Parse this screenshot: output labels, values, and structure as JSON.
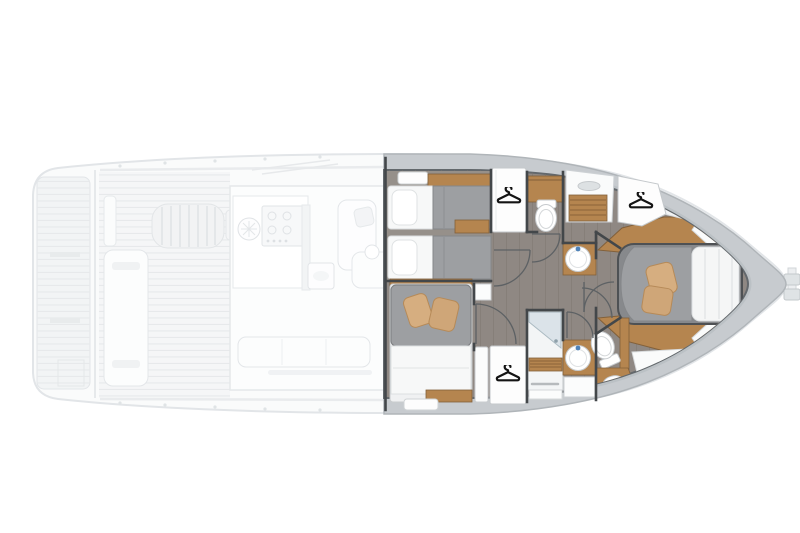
{
  "meta": {
    "alt": "Motor yacht deck plan: ghosted main deck aft (swim platform, cockpit, galley and salon) and a rendered lower deck forward with guest cabins, heads and owner cabin in the bow"
  },
  "palette": {
    "background": "#ffffff",
    "ghost_fill": "#f4f5f6",
    "ghost_line": "#e2e5e8",
    "hull_band": "#c7cbcf",
    "hull_band_edge": "#b0b5b9",
    "floor_wood": "#8f8883",
    "floor_plank_line": "#7a736d",
    "teak_wood": "#b5854f",
    "teak_edge": "#82603a",
    "wall": "#43474a",
    "duvet_gray": "#9d9fa2",
    "linen_white": "#f7f8f8",
    "pillow_tan": "#d6ae80",
    "fixture_white": "#ffffff",
    "fixture_edge": "#c6cacd",
    "glass_blue": "#d7e1e7",
    "faucet_blue": "#4f82b8",
    "hanger_black": "#141414"
  },
  "icons": {
    "hanger": {
      "count": 3,
      "positions": [
        {
          "area": "guest-wardrobe-forward",
          "x": 509,
          "y": 198
        },
        {
          "area": "guest-wardrobe-aft",
          "x": 508,
          "y": 376
        },
        {
          "area": "owner-wardrobe",
          "x": 641,
          "y": 203
        }
      ]
    }
  },
  "lower_deck_rooms": [
    {
      "id": "twin-guest-cabin",
      "fixtures": [
        "single-bed",
        "single-bed",
        "nightstand",
        "overhead-hatch",
        "wardrobe"
      ]
    },
    {
      "id": "guest-head",
      "fixtures": [
        "toilet",
        "round-washbasin",
        "shower-teak-grate"
      ]
    },
    {
      "id": "double-guest-cabin",
      "fixtures": [
        "double-bed",
        "two-pillows",
        "nightstand",
        "wardrobe"
      ]
    },
    {
      "id": "day-head",
      "fixtures": [
        "shower-cabin",
        "round-washbasin",
        "cabinet"
      ]
    },
    {
      "id": "owner-cabin",
      "fixtures": [
        "island-double-bed",
        "two-pillows",
        "wardrobe",
        "side-benches",
        "deck-hatches"
      ]
    },
    {
      "id": "owner-head",
      "fixtures": [
        "toilet",
        "washbasin-counter"
      ]
    }
  ],
  "ghost_main_deck": {
    "areas": [
      "swim-platform",
      "aft-deck",
      "cockpit-bench",
      "engine-hatch",
      "galley-with-stove",
      "round-deck-hatch",
      "dinette-sofa",
      "coffee-table",
      "aft-sofa",
      "side-decks"
    ]
  },
  "exterior": {
    "bowsprit": true,
    "bow_direction": "right"
  }
}
